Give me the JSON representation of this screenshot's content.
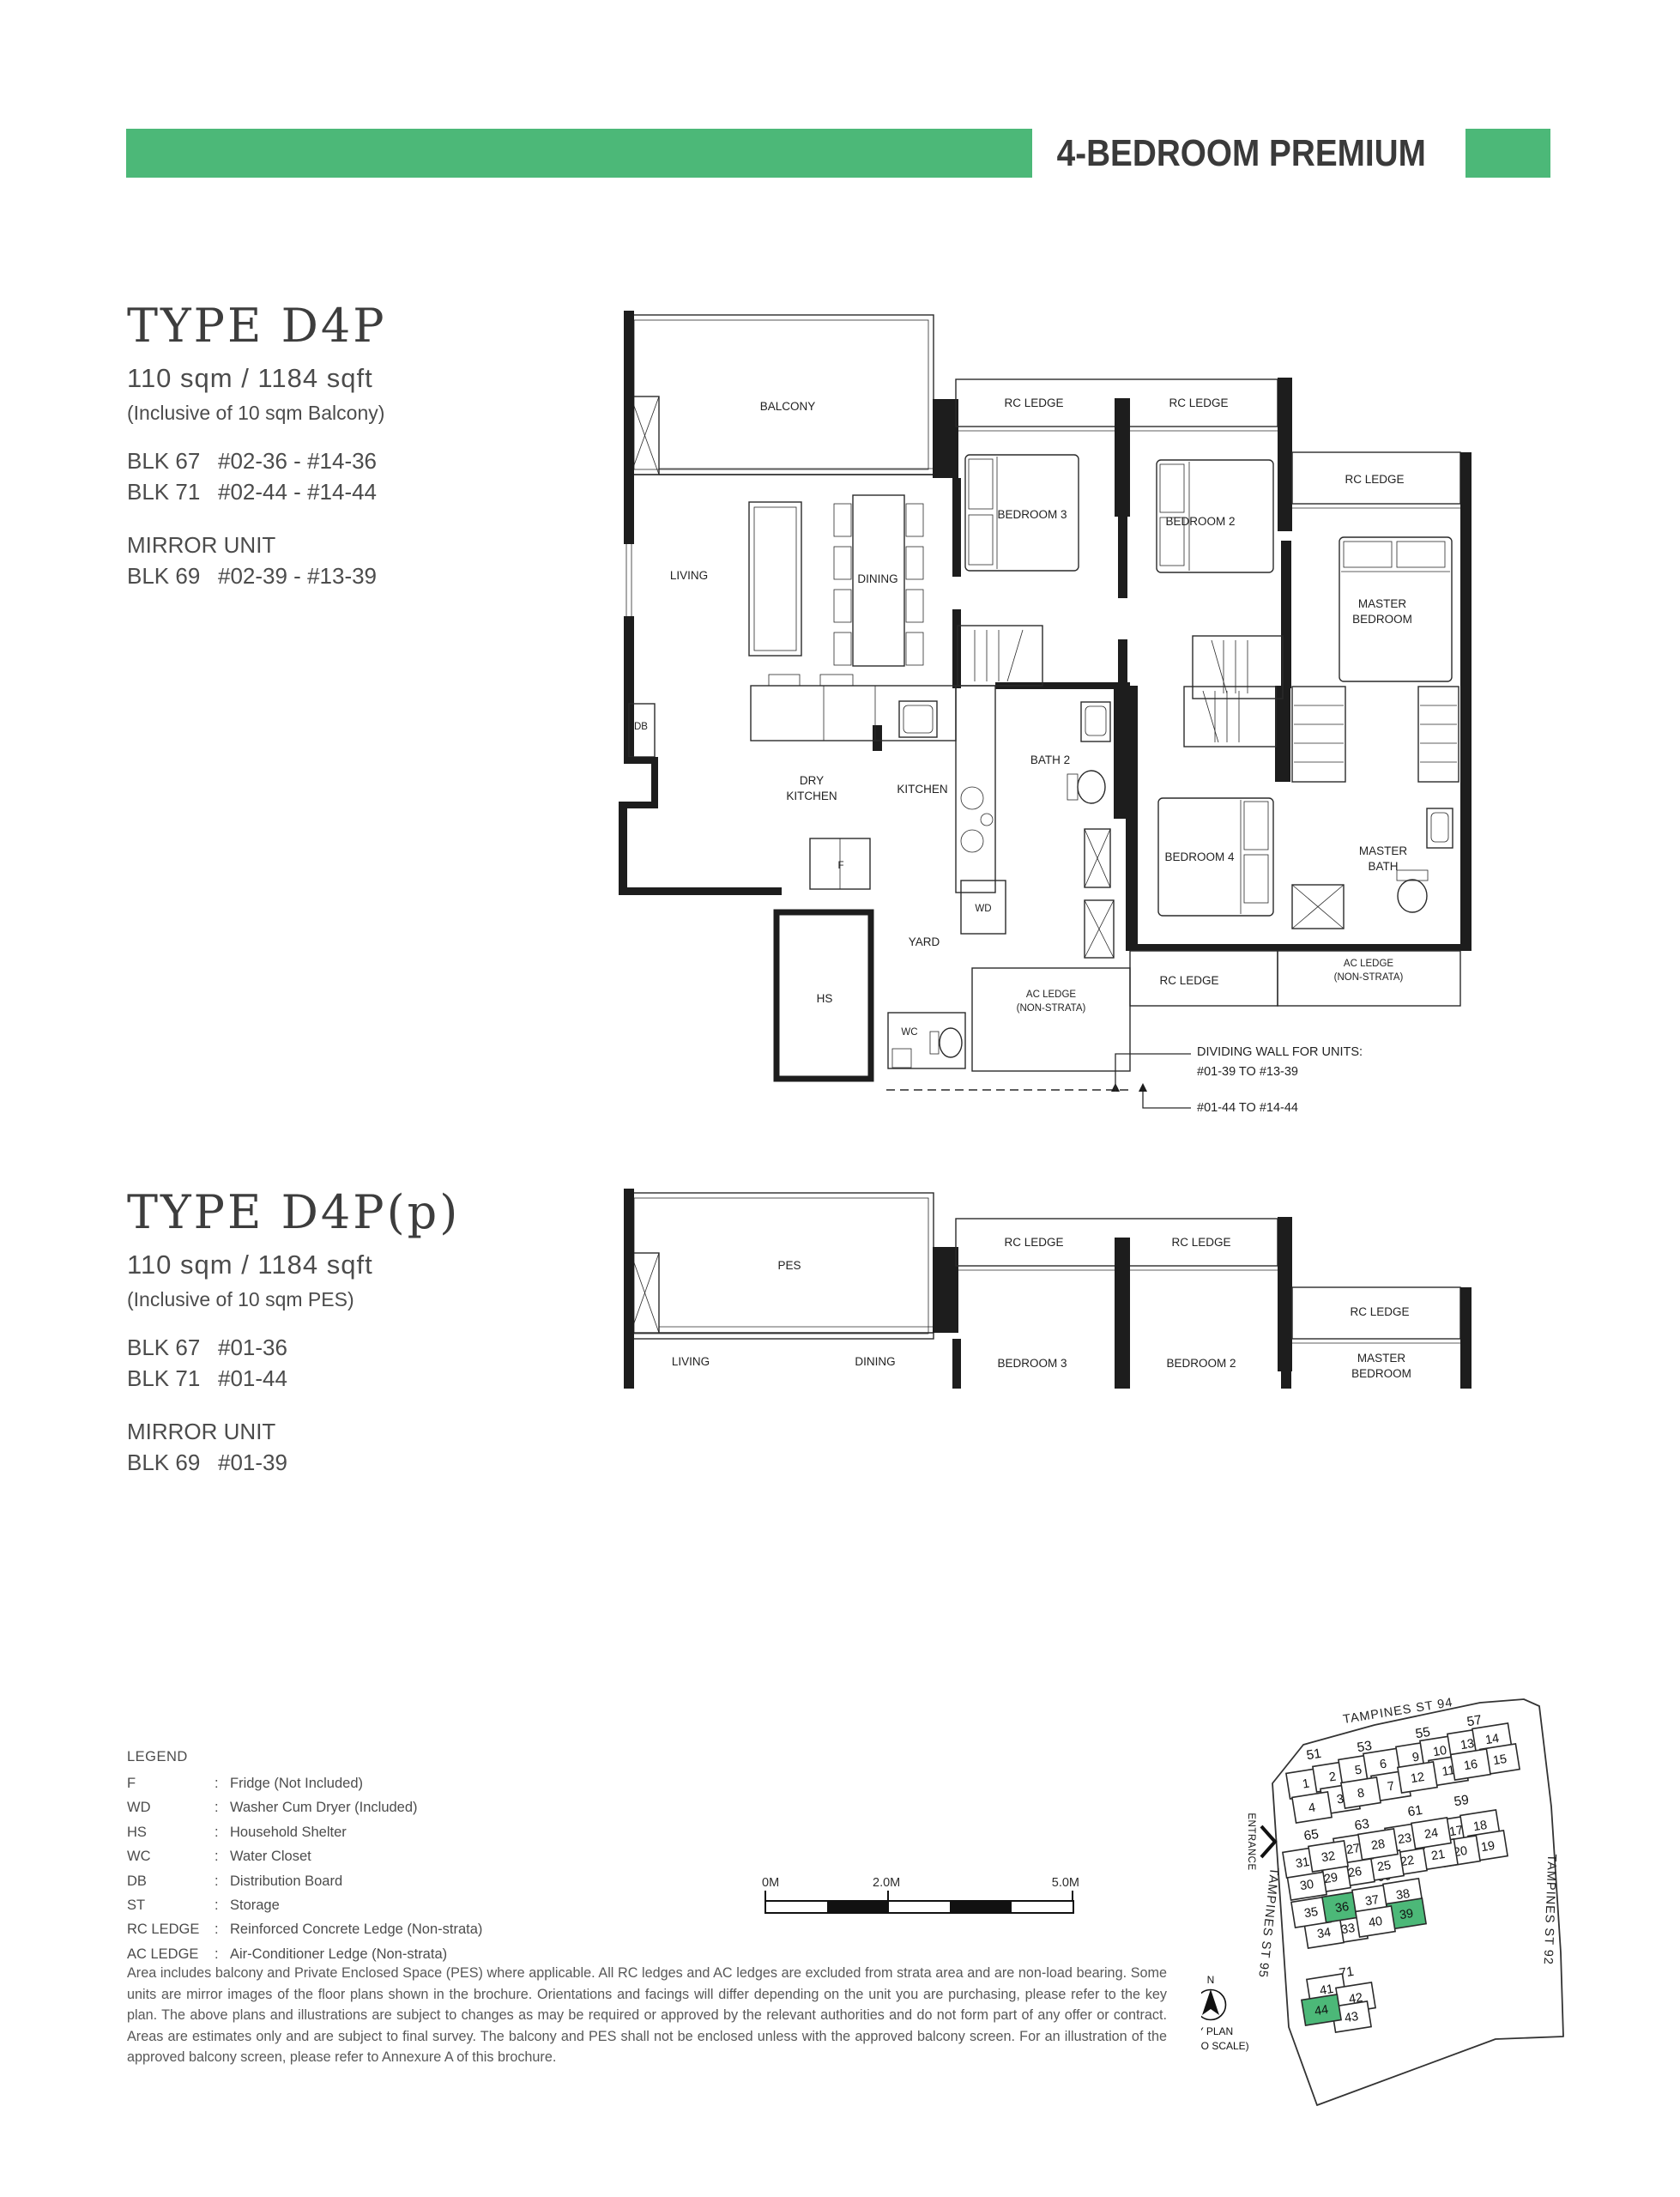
{
  "header": {
    "title": "4-BEDROOM PREMIUM",
    "accent_color": "#4cb878"
  },
  "unit_d4p": {
    "type_name": "TYPE D4P",
    "area": "110 sqm / 1184 sqft",
    "inclusive_note": "(Inclusive of 10 sqm Balcony)",
    "blocks": [
      {
        "blk": "BLK 67",
        "units": "#02-36 - #14-36"
      },
      {
        "blk": "BLK 71",
        "units": "#02-44 - #14-44"
      }
    ],
    "mirror_label": "MIRROR UNIT",
    "mirror_blocks": [
      {
        "blk": "BLK 69",
        "units": "#02-39 - #13-39"
      }
    ]
  },
  "unit_d4pp": {
    "type_name": "TYPE D4P(p)",
    "area": "110 sqm / 1184 sqft",
    "inclusive_note": "(Inclusive of 10 sqm PES)",
    "blocks": [
      {
        "blk": "BLK 67",
        "units": "#01-36"
      },
      {
        "blk": "BLK 71",
        "units": "#01-44"
      }
    ],
    "mirror_label": "MIRROR UNIT",
    "mirror_blocks": [
      {
        "blk": "BLK 69",
        "units": "#01-39"
      }
    ]
  },
  "plan_a": {
    "labels": {
      "balcony": "BALCONY",
      "rc1": "RC LEDGE",
      "rc2": "RC LEDGE",
      "rc3": "RC LEDGE",
      "living": "LIVING",
      "dining": "DINING",
      "bed3": "BEDROOM 3",
      "bed2": "BEDROOM 2",
      "master1": "MASTER",
      "master2": "BEDROOM",
      "db": "DB",
      "dry1": "DRY",
      "dry2": "KITCHEN",
      "kitchen": "KITCHEN",
      "bath2": "BATH 2",
      "f": "F",
      "wd": "WD",
      "yard": "YARD",
      "hs": "HS",
      "wc": "WC",
      "bed4": "BEDROOM 4",
      "mbath1": "MASTER",
      "mbath2": "BATH",
      "ac1a": "AC LEDGE",
      "ac1b": "(NON-STRATA)",
      "ac2a": "AC LEDGE",
      "ac2b": "(NON-STRATA)",
      "rcb": "RC LEDGE"
    },
    "callout": {
      "c1": "DIVIDING WALL FOR UNITS:",
      "c2": "#01-39 TO #13-39",
      "c3": "#01-44 TO #14-44"
    }
  },
  "plan_b": {
    "labels": {
      "pes": "PES",
      "rc1": "RC LEDGE",
      "rc2": "RC LEDGE",
      "rc3": "RC LEDGE",
      "living": "LIVING",
      "dining": "DINING",
      "bed3": "BEDROOM 3",
      "bed2": "BEDROOM 2",
      "master1": "MASTER",
      "master2": "BEDROOM"
    }
  },
  "legend": {
    "title": "LEGEND",
    "separator": ":",
    "items": [
      {
        "key": "F",
        "desc": "Fridge (Not Included)"
      },
      {
        "key": "WD",
        "desc": "Washer Cum Dryer (Included)"
      },
      {
        "key": "HS",
        "desc": "Household Shelter"
      },
      {
        "key": "WC",
        "desc": "Water Closet"
      },
      {
        "key": "DB",
        "desc": "Distribution Board"
      },
      {
        "key": "ST",
        "desc": "Storage"
      },
      {
        "key": "RC LEDGE",
        "desc": "Reinforced Concrete Ledge (Non-strata)"
      },
      {
        "key": "AC LEDGE",
        "desc": "Air-Conditioner Ledge (Non-strata)"
      }
    ]
  },
  "scalebar": {
    "label_0": "0M",
    "label_2": "2.0M",
    "label_5": "5.0M"
  },
  "disclaimer": "Area includes balcony and Private Enclosed Space (PES) where applicable. All RC ledges and AC ledges are excluded from strata area and are non-load bearing. Some units are mirror images of the floor plans shown in the brochure. Orientations and facings will differ depending on the unit you are purchasing, please refer to the key plan. The above plans and illustrations are subject to changes as may be required or approved by the relevant authorities and do not form part of any offer or contract. Areas are estimates only and are subject to final survey. The balcony and PES shall not be enclosed unless with the approved balcony screen. For an illustration of the approved balcony screen, please refer to Annexure A of this brochure.",
  "keyplan": {
    "street_top": "TAMPINES ST 94",
    "street_right": "TAMPINES ST 92",
    "street_left": "TAMPINES ST 95",
    "entrance": "ENTRANCE",
    "north": "N",
    "caption_line1": "KEY PLAN",
    "caption_line2": "(NOT TO SCALE)",
    "highlight_color": "#4cb878",
    "clusters": [
      "51",
      "53",
      "55",
      "57",
      "65",
      "63",
      "61",
      "59",
      "67",
      "69",
      "71"
    ],
    "blocks": [
      {
        "n": "1"
      },
      {
        "n": "2"
      },
      {
        "n": "3"
      },
      {
        "n": "4"
      },
      {
        "n": "5"
      },
      {
        "n": "6"
      },
      {
        "n": "7"
      },
      {
        "n": "8"
      },
      {
        "n": "9"
      },
      {
        "n": "10"
      },
      {
        "n": "11"
      },
      {
        "n": "12"
      },
      {
        "n": "13"
      },
      {
        "n": "14"
      },
      {
        "n": "15"
      },
      {
        "n": "16"
      },
      {
        "n": "17"
      },
      {
        "n": "18"
      },
      {
        "n": "19"
      },
      {
        "n": "20"
      },
      {
        "n": "21"
      },
      {
        "n": "22"
      },
      {
        "n": "23"
      },
      {
        "n": "24"
      },
      {
        "n": "25"
      },
      {
        "n": "26"
      },
      {
        "n": "27"
      },
      {
        "n": "28"
      },
      {
        "n": "29"
      },
      {
        "n": "30"
      },
      {
        "n": "31"
      },
      {
        "n": "32"
      },
      {
        "n": "33"
      },
      {
        "n": "34"
      },
      {
        "n": "35"
      },
      {
        "n": "36",
        "g": true
      },
      {
        "n": "37"
      },
      {
        "n": "38"
      },
      {
        "n": "39",
        "g": true
      },
      {
        "n": "40"
      },
      {
        "n": "41"
      },
      {
        "n": "42"
      },
      {
        "n": "43"
      },
      {
        "n": "44",
        "g": true
      }
    ]
  }
}
